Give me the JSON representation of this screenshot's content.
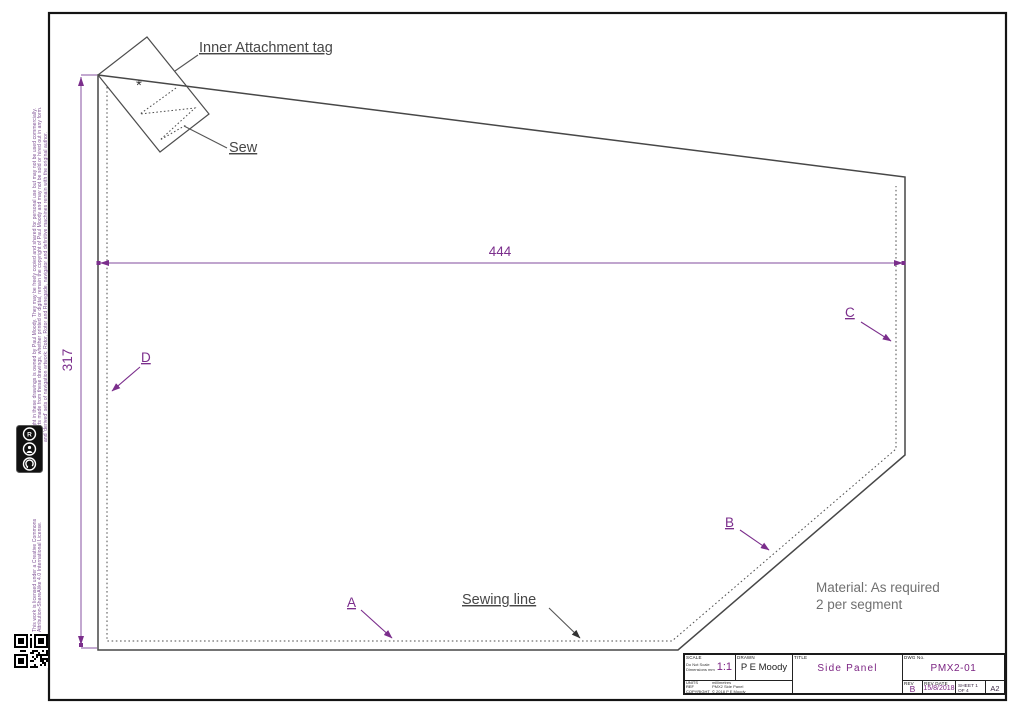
{
  "colors": {
    "accent_purple": "#7b2382",
    "dim_purple": "#9b6fb0",
    "line_gray": "#474747",
    "text_gray": "#707070",
    "margin_purple": "#7d4f93"
  },
  "margin": {
    "copyright_text": "Copyright in these drawings is owned by Paul Moody. They may be freely copied and shared for personal use but may not be used commercially.\nThe parts made from these drawings, whether printed or digital, remain the copyright of Paul Moody and may not be sold or hired out in any form.\nand 'derived' sets of navigation artwork: Rotor, Rotor and Renegade, navigator and definitive machines remain with the original author.",
    "cc_badge": "creative-commons-by-sa-badge",
    "license_text": "This work is licensed under a Creative Commons\nAttribution-ShareAlike 4.0 International License.",
    "qr_code": "qr-code"
  },
  "drawing": {
    "tag_label": "Inner Attachment tag",
    "sew_label": "Sew",
    "sewing_line_label": "Sewing line",
    "material_line1": "Material: As required",
    "material_line2": "2 per segment",
    "dim_width": "444",
    "dim_height": "317",
    "asterisk": "*",
    "labels": {
      "a": "A",
      "b": "B",
      "c": "C",
      "d": "D"
    }
  },
  "title_block": {
    "scale_label": "SCALE",
    "scale_note1": "Do Not Scale",
    "scale_note2": "Dimensions mm",
    "scale_value": "1:1",
    "drawn_label": "DRAWN",
    "drawn_value": "P E Moody",
    "title_label": "TITLE",
    "title_value": "Side Panel",
    "dwg_label": "DWG No.",
    "dwg_value": "PMX2-01",
    "rev_label": "REV",
    "rev_value": "B",
    "revdate_label": "REV DATE",
    "revdate_value": "15/8/2018",
    "sheet_line1": "SHEET 1",
    "sheet_line2": "OF 4",
    "size_value": "A2",
    "units_label": "UNITS",
    "units_value": "millimetres",
    "ref_label": "REF",
    "ref_value": "PMX2 Side Panel",
    "copyright_label": "COPYRIGHT",
    "copyright_value": "© 2018 P E Moody"
  }
}
